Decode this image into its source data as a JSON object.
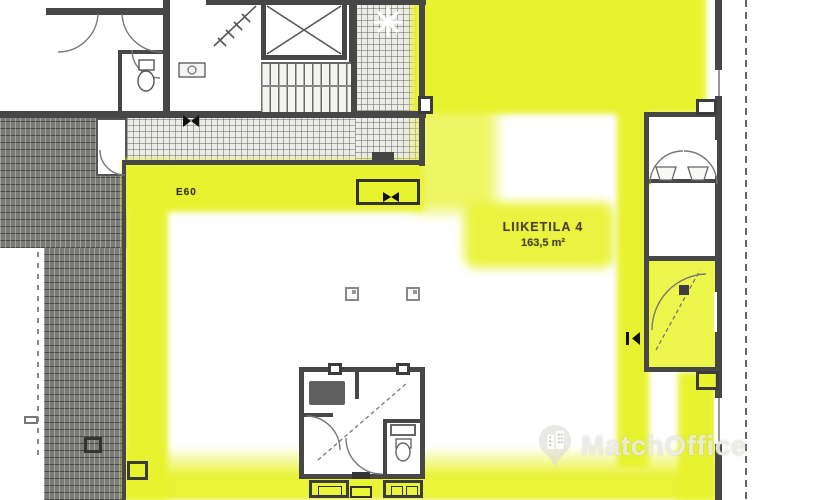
{
  "plan": {
    "unit_label": "LIIKETILA 4",
    "unit_area": "163,5 m²",
    "fire_rating_label": "E60"
  },
  "watermark": {
    "brand": "MatchOffice",
    "icon": "location-pin-building-icon"
  },
  "colors": {
    "highlight_yellow": "#e8f330",
    "wall_dark": "#474747",
    "paver_gray": "#7b7b78",
    "line_gray": "#6e6e6e",
    "label_ink": "#4a432c",
    "watermark_white": "rgba(238,238,232,0.88)"
  },
  "symbols": [
    "elevator-cross-icon",
    "stair-treads-icon",
    "door-swing-arc-icon",
    "column-square-icon",
    "compass-star-icon",
    "boundary-dashed-line",
    "toilet-icon",
    "sink-icon",
    "door-bowtie-icon"
  ]
}
